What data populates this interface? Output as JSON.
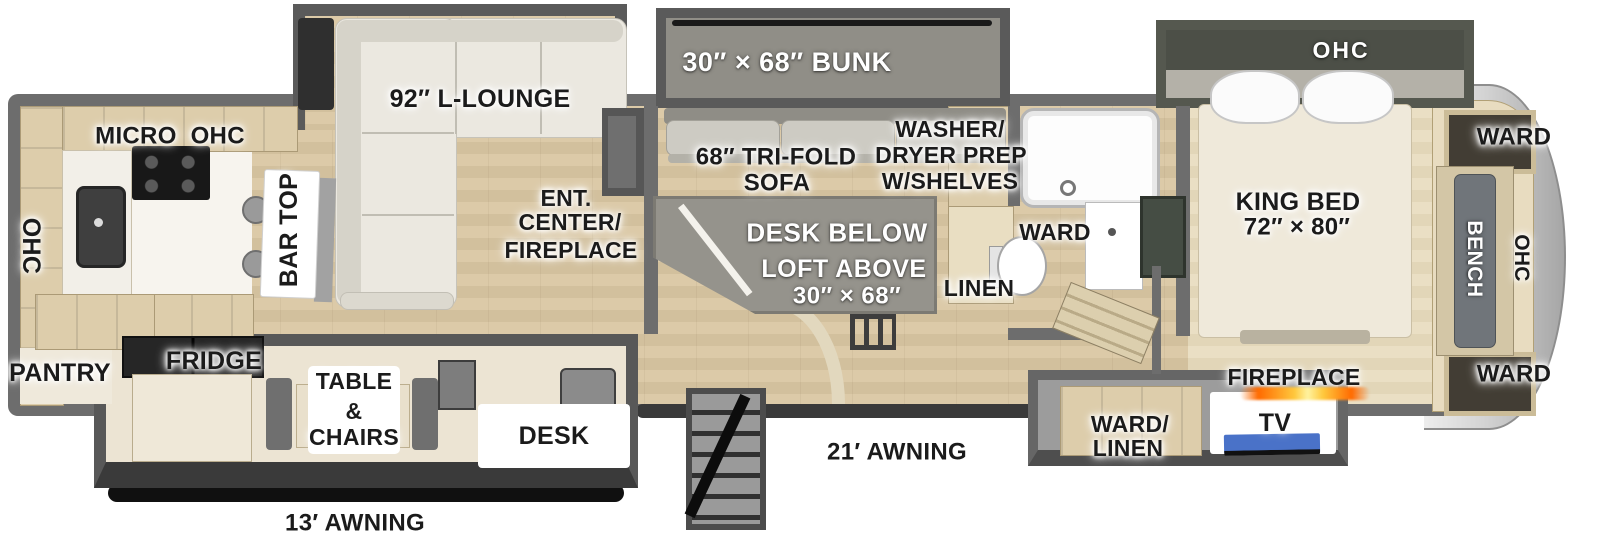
{
  "title": "RV fifth-wheel floorplan",
  "colors": {
    "floor_wood": "#d8c7a5",
    "bedroom_carpet": "#e7ddc1",
    "wall_gray": "#6d6d6d",
    "slide_wall": "#585858",
    "bunk_carpet": "#908e87",
    "sofa_cream": "#ebe8e0",
    "cabinet_tan": "#ddcdab",
    "tv_screen_blue": "#4a72c8",
    "flame_orange": "#ff6a00",
    "flame_yellow": "#ffe14a",
    "front_cap_silver": "#cdcdcd"
  },
  "labels": {
    "micro_ohc": "MICRO  OHC",
    "ohc_left": "OHC",
    "pantry": "PANTRY",
    "fridge": "FRIDGE",
    "bar_top": "BAR TOP",
    "l_lounge": "92″ L-LOUNGE",
    "ent_center_1": "ENT.",
    "ent_center_2": "CENTER/",
    "ent_center_3": "FIREPLACE",
    "table_1": "TABLE",
    "table_2": "&",
    "table_3": "CHAIRS",
    "desk": "DESK",
    "awning_13": "13′ AWNING",
    "awning_21": "21′ AWNING",
    "bunk": "30″ × 68″ BUNK",
    "trifold_1": "68″ TRI-FOLD",
    "trifold_2": "SOFA",
    "desk_below": "DESK BELOW",
    "loft_above_1": "LOFT ABOVE",
    "loft_above_2": "30″ × 68″",
    "washer_1": "WASHER/",
    "washer_2": "DRYER PREP",
    "washer_3": "W/SHELVES",
    "ward_bath": "WARD",
    "linen_bath": "LINEN",
    "king_bed_1": "KING BED",
    "king_bed_2": "72″ × 80″",
    "ohc_bed_slide": "OHC",
    "ward_top_right": "WARD",
    "ward_bottom_right": "WARD",
    "bench": "BENCH",
    "ohc_front": "OHC",
    "ward_linen_1": "WARD/",
    "ward_linen_2": "LINEN",
    "tv": "TV",
    "fireplace": "FIREPLACE"
  }
}
